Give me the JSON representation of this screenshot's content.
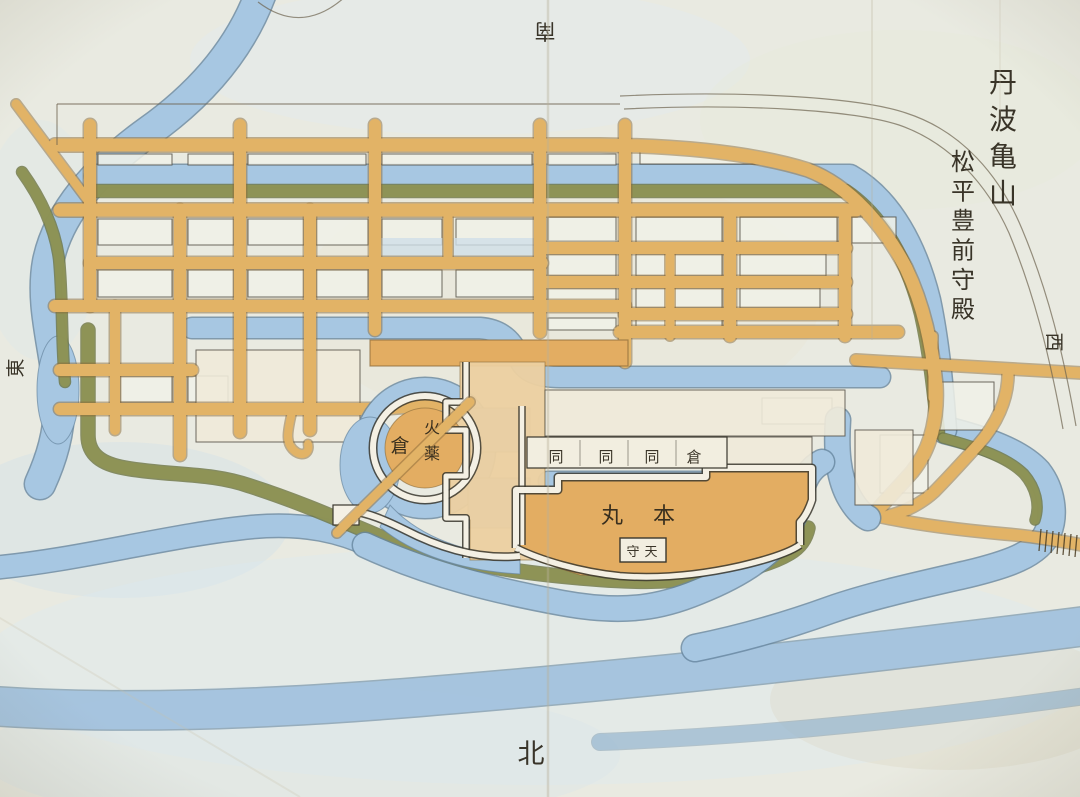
{
  "map": {
    "region_title": "丹波亀山",
    "holder_title": "松平豊前守殿",
    "compass": {
      "north": "北",
      "south": "南",
      "east": "東",
      "west": "西"
    },
    "castle": {
      "honmaru_label": "本丸",
      "honmaru_chars": [
        "丸",
        "本"
      ],
      "tenshu_label": "天守",
      "tenshu_chars": [
        "守",
        "天"
      ],
      "powder_magazine_label": "火薬",
      "powder_store_label": "倉",
      "storehouse_row_label": "倉同同同",
      "storehouse_row_chars": [
        "同",
        "同",
        "同",
        "倉"
      ]
    },
    "palette": {
      "paper": "#e9eae1",
      "water": "#a7c7e2",
      "water_edge": "#66869f",
      "road": "#e2b366",
      "road_edge": "#8a6a38",
      "embankment": "#8e9355",
      "embankment_edge": "#6d7442",
      "castle_ground": "#e3ad62",
      "block": "#f0f1e8",
      "wall": "#f4f0e4",
      "ink": "#2b2519"
    }
  }
}
